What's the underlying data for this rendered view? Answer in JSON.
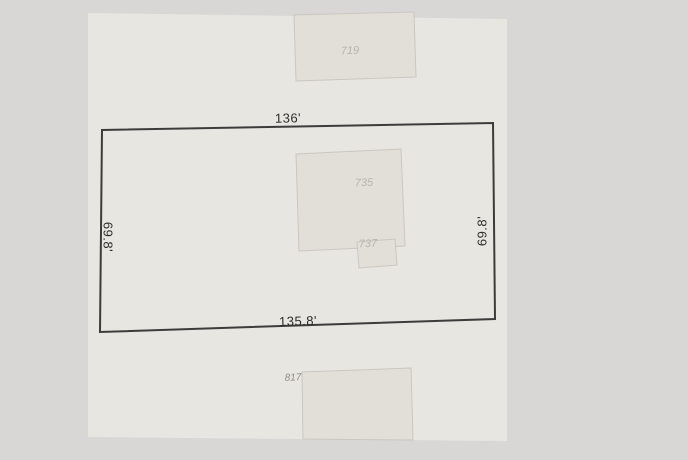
{
  "colors": {
    "page_bg": "#d8d7d5",
    "land": "#e8e6e1",
    "building_fill": "#e2dfd9",
    "building_stroke": "#cac7c1",
    "parcel_stroke": "#3d3c3a",
    "dim_text": "#2e2d2b",
    "building_label": "#b7b4ae",
    "building_label_dark": "#8f8d88",
    "no_fill": "none"
  },
  "parcel": {
    "dimensions": {
      "top": "136'",
      "bottom": "135.8'",
      "left": "69.8'",
      "right": "69.8'"
    }
  },
  "buildings": [
    {
      "label": "719"
    },
    {
      "label": "735"
    },
    {
      "label": "737"
    },
    {
      "label": "817"
    }
  ]
}
